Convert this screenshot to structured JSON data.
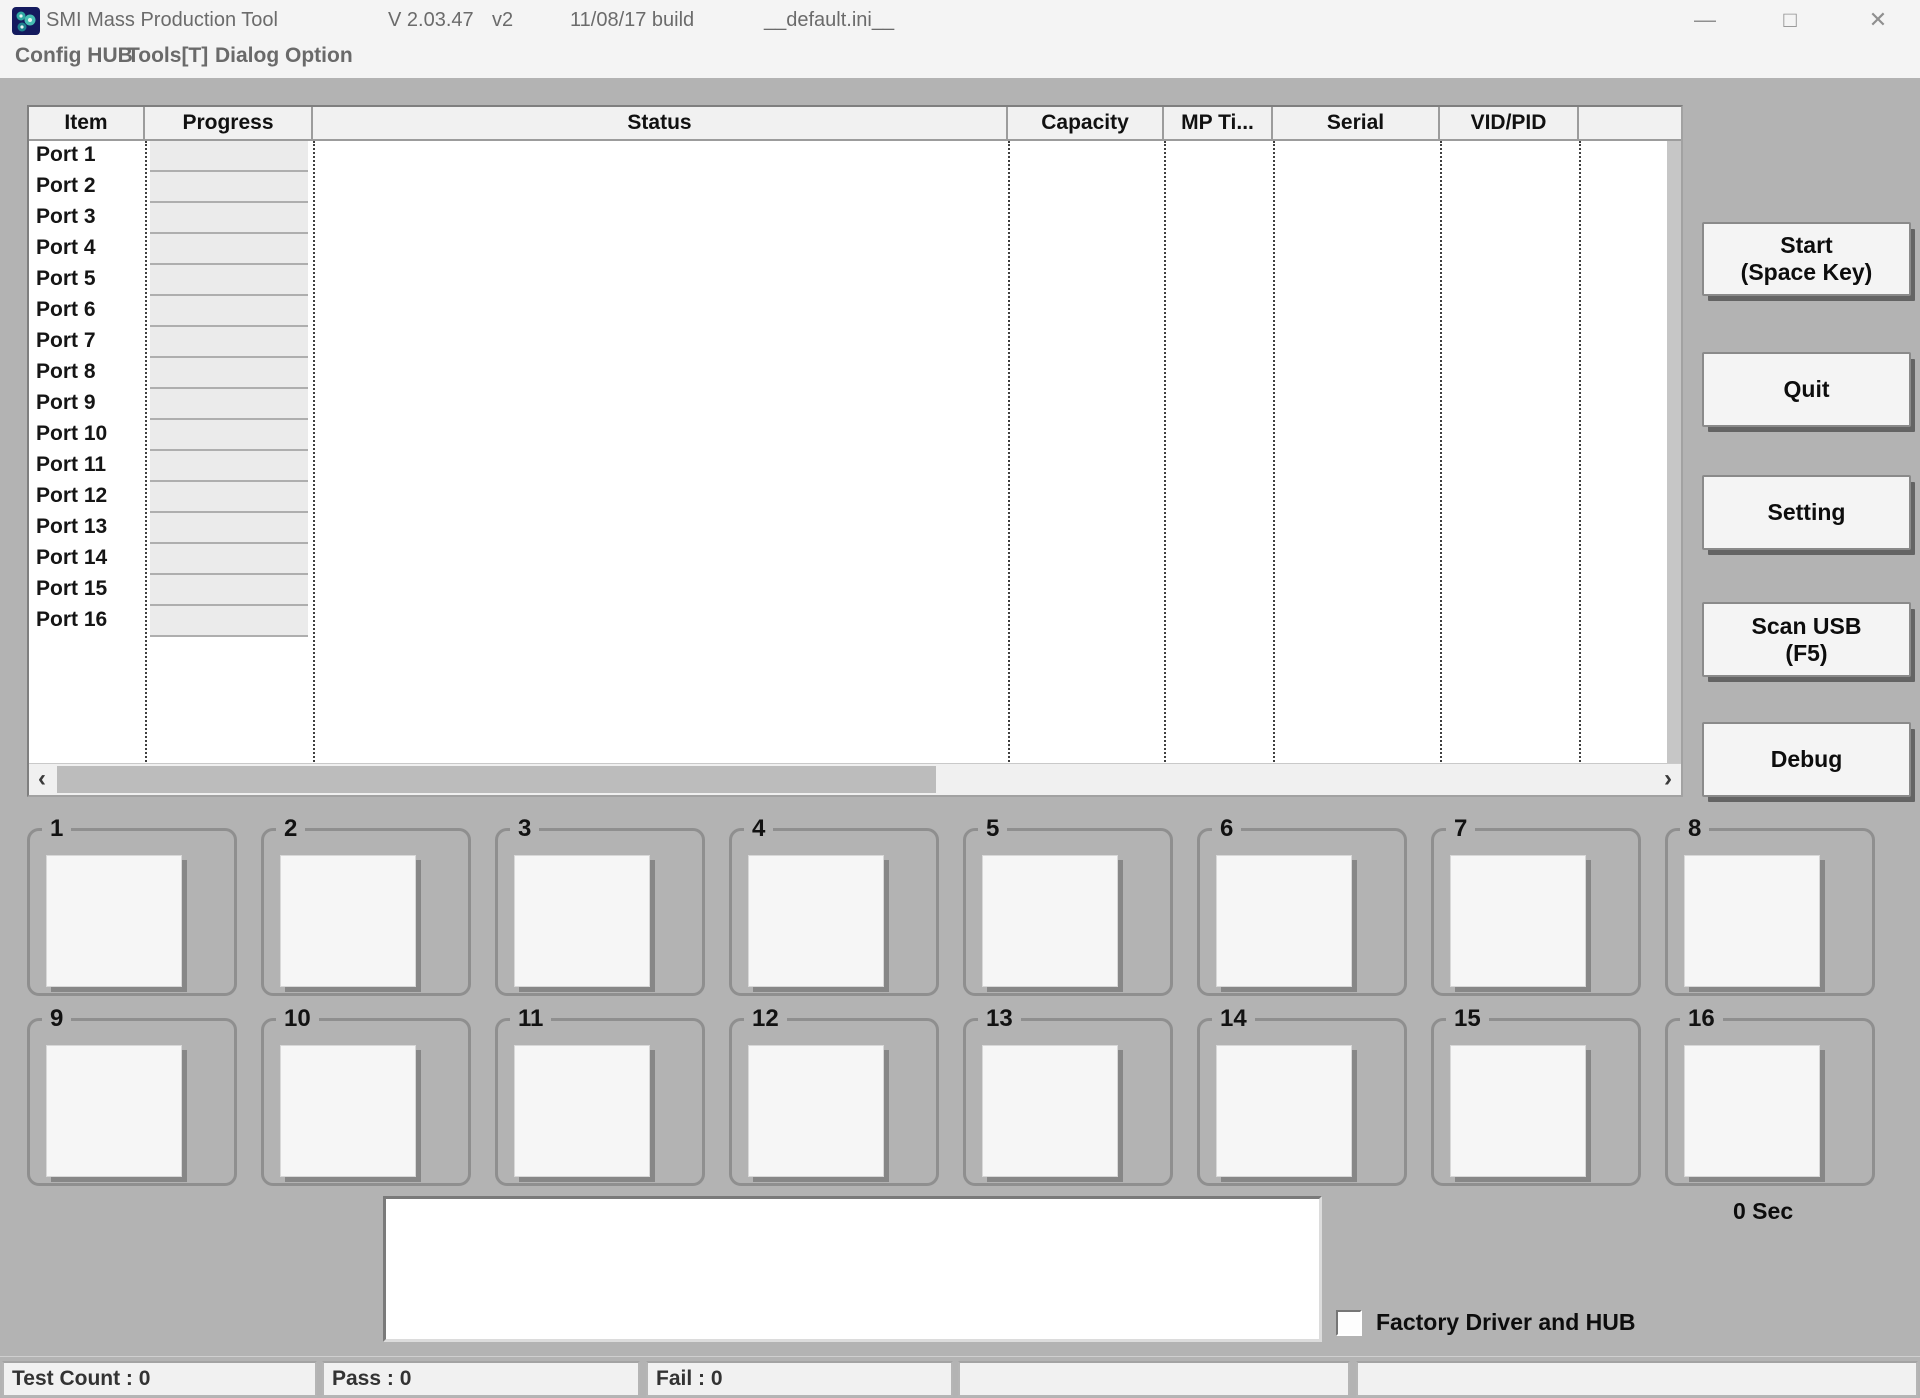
{
  "window": {
    "app_title": "SMI Mass Production Tool",
    "version": "V 2.03.47",
    "version_tag": "v2",
    "build": "11/08/17 build",
    "ini_file": "__default.ini__",
    "controls": {
      "minimize": "—",
      "maximize": "□",
      "close": "✕"
    }
  },
  "menu": {
    "items": [
      {
        "label": "Config HUB"
      },
      {
        "label": "Tools[T]"
      },
      {
        "label": "Dialog Option"
      }
    ]
  },
  "table": {
    "columns": [
      "Item",
      "Progress",
      "Status",
      "Capacity",
      "MP Ti...",
      "Serial",
      "VID/PID",
      ""
    ],
    "rows": [
      "Port 1",
      "Port 2",
      "Port 3",
      "Port 4",
      "Port 5",
      "Port 6",
      "Port 7",
      "Port 8",
      "Port 9",
      "Port 10",
      "Port 11",
      "Port 12",
      "Port 13",
      "Port 14",
      "Port 15",
      "Port 16"
    ]
  },
  "scrollbar": {
    "left_arrow": "‹",
    "right_arrow": "›"
  },
  "actions": {
    "start": {
      "label": "Start",
      "sublabel": "(Space Key)"
    },
    "quit": {
      "label": "Quit"
    },
    "setting": {
      "label": "Setting"
    },
    "scan_usb": {
      "label": "Scan USB",
      "sublabel": "(F5)"
    },
    "debug": {
      "label": "Debug"
    }
  },
  "ports": {
    "labels": [
      "1",
      "2",
      "3",
      "4",
      "5",
      "6",
      "7",
      "8",
      "9",
      "10",
      "11",
      "12",
      "13",
      "14",
      "15",
      "16"
    ]
  },
  "footer": {
    "message": "",
    "timer": "0 Sec",
    "factory_checkbox": {
      "label": "Factory Driver and HUB",
      "checked": false
    }
  },
  "statusbar": {
    "test_count": "Test Count : 0",
    "pass": "Pass : 0",
    "fail": "Fail : 0",
    "panel4": "",
    "panel5": ""
  },
  "colors": {
    "client_bg": "#b3b3b3",
    "chrome_bg": "#f4f4f4",
    "table_bg": "#ffffff",
    "header_bg": "#f1f1f1",
    "progress_cell_bg": "#ebebeb",
    "button_bg": "#f4f4f4",
    "button_shadow": "#646464",
    "icon_navy": "#141a5e",
    "icon_teal": "#2fa8a2",
    "text": "#111111",
    "muted_text": "#6b6b6b"
  }
}
